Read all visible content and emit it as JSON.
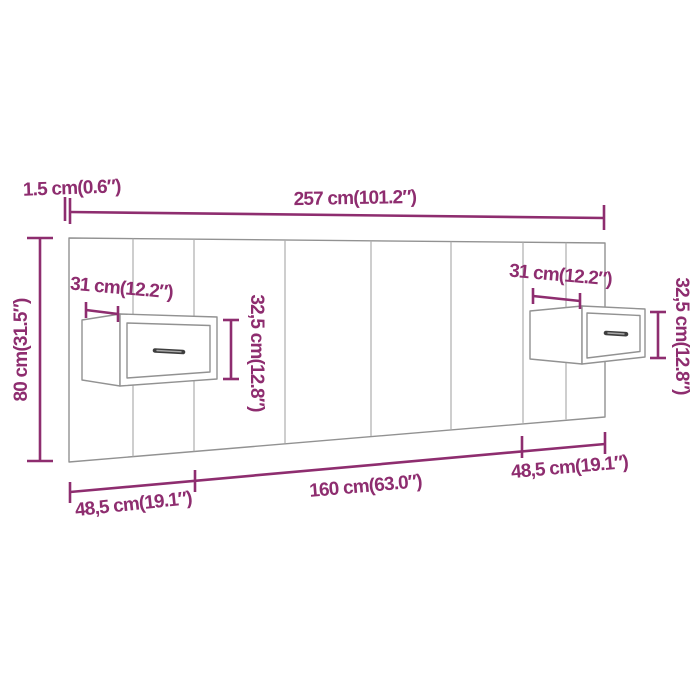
{
  "diagram": {
    "subject": "wall headboard with two floating bedside cabinets, dimension drawing",
    "colors": {
      "dimension_accent": "#8E2D6F",
      "furniture_outline": "#929292",
      "panel_divider": "#AEAEAE",
      "handle": "#3E3E3E",
      "background": "#FFFFFF"
    },
    "labels": {
      "panel_thickness": "1.5 cm(0.6″)",
      "total_width": "257 cm(101.2″)",
      "total_height": "80 cm(31.5″)",
      "left_cabinet_width": "31 cm(12.2″)",
      "right_cabinet_width": "31 cm(12.2″)",
      "left_cabinet_height": "32,5 cm(12.8″)",
      "right_cabinet_height": "32,5 cm(12.8″)",
      "bottom_left_segment": "48,5 cm(19.1″)",
      "bottom_middle_segment": "160 cm(63.0″)",
      "bottom_right_segment": "48,5 cm(19.1″)"
    }
  }
}
